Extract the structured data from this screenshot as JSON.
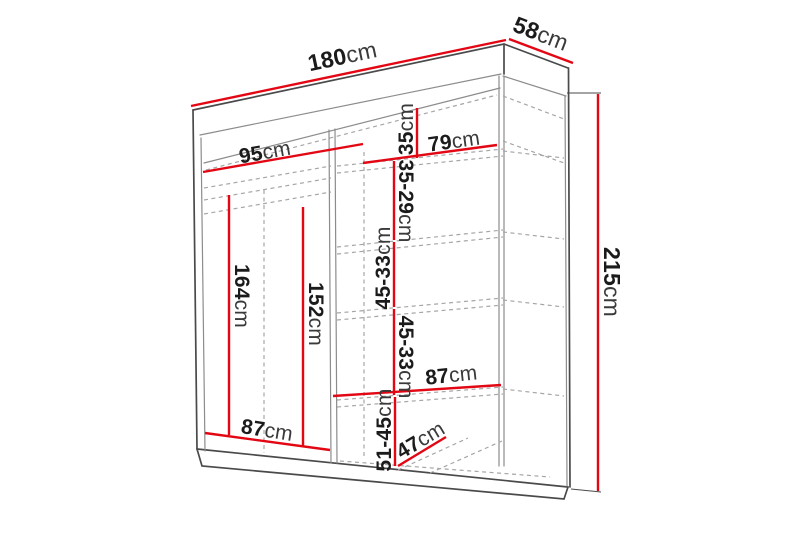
{
  "diagram": {
    "type": "furniture-dimension-diagram",
    "subject": "two-door sliding wardrobe with shelves and hanging section",
    "unit": "cm"
  },
  "colors": {
    "dimension_red": "#e30613",
    "outline_dark": "#4a4a4a",
    "outline_mid": "#8c8c8c",
    "hidden_dashed": "#a6a6a6",
    "label_text": "#1b1b1b",
    "unit_text": "#3a3a3a",
    "background": "#ffffff"
  },
  "dimensions": {
    "width": {
      "value": "180",
      "unit": "cm"
    },
    "depth": {
      "value": "58",
      "unit": "cm"
    },
    "height": {
      "value": "215",
      "unit": "cm"
    },
    "left_section_width": {
      "value": "95",
      "unit": "cm"
    },
    "right_section_width": {
      "value": "79",
      "unit": "cm"
    },
    "top_shelf_spacing": {
      "value": "35",
      "unit": "cm"
    },
    "upper_shelf_spacing": {
      "value": "35-29",
      "unit": "cm"
    },
    "middle_shelf_spacing_1": {
      "value": "45-33",
      "unit": "cm"
    },
    "middle_shelf_spacing_2": {
      "value": "45-33",
      "unit": "cm"
    },
    "shelf_width": {
      "value": "87",
      "unit": "cm"
    },
    "bottom_shelf_spacing": {
      "value": "51-45",
      "unit": "cm"
    },
    "shelf_depth": {
      "value": "47",
      "unit": "cm"
    },
    "bottom_left_width": {
      "value": "87",
      "unit": "cm"
    },
    "left_hanging_height": {
      "value": "164",
      "unit": "cm"
    },
    "left_rail_height": {
      "value": "152",
      "unit": "cm"
    }
  }
}
